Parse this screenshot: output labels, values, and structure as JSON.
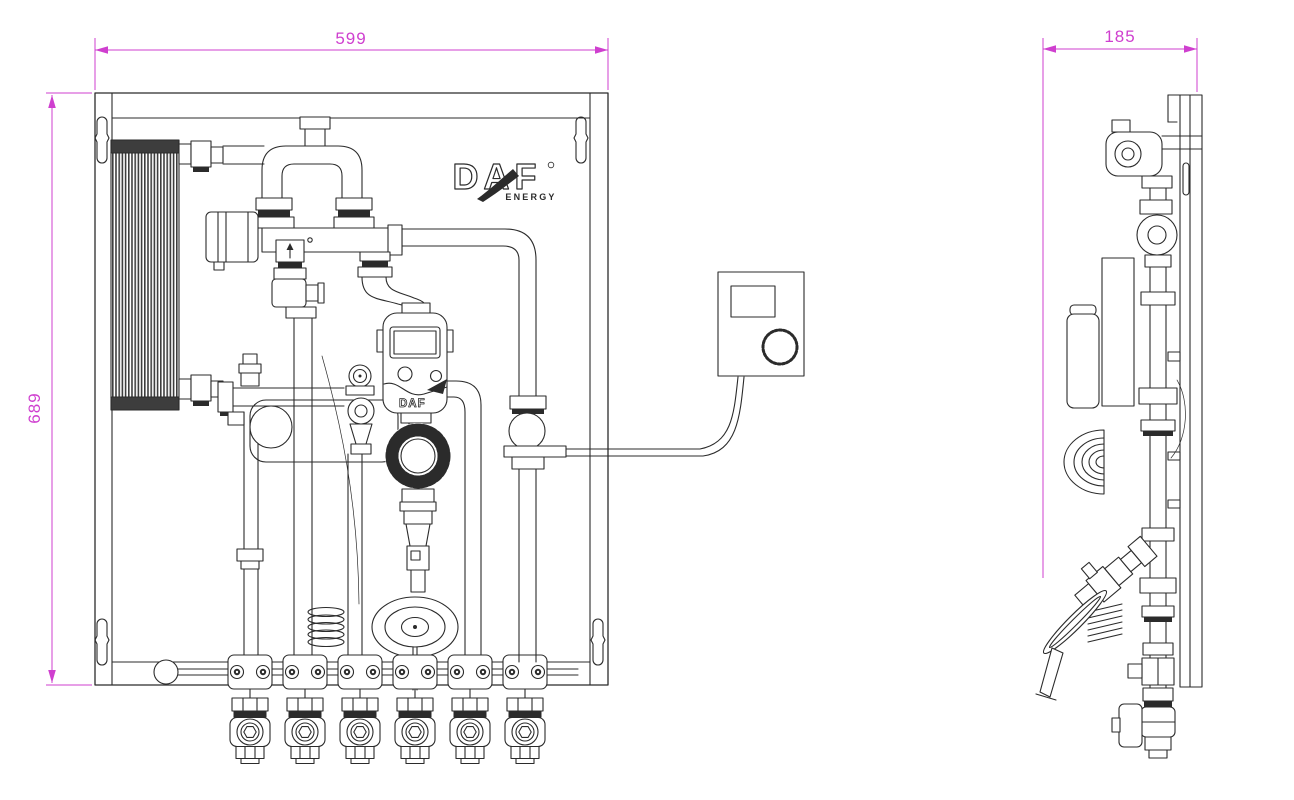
{
  "dimensions": {
    "front_width": "599",
    "front_height": "689",
    "side_depth": "185"
  },
  "logo": {
    "brand": "DAF",
    "sub": "ENERGY"
  },
  "pump": {
    "label": "DAF"
  },
  "colors": {
    "dimension": "#cf3fcf",
    "line": "#2b2b2b",
    "background": "#ffffff"
  }
}
